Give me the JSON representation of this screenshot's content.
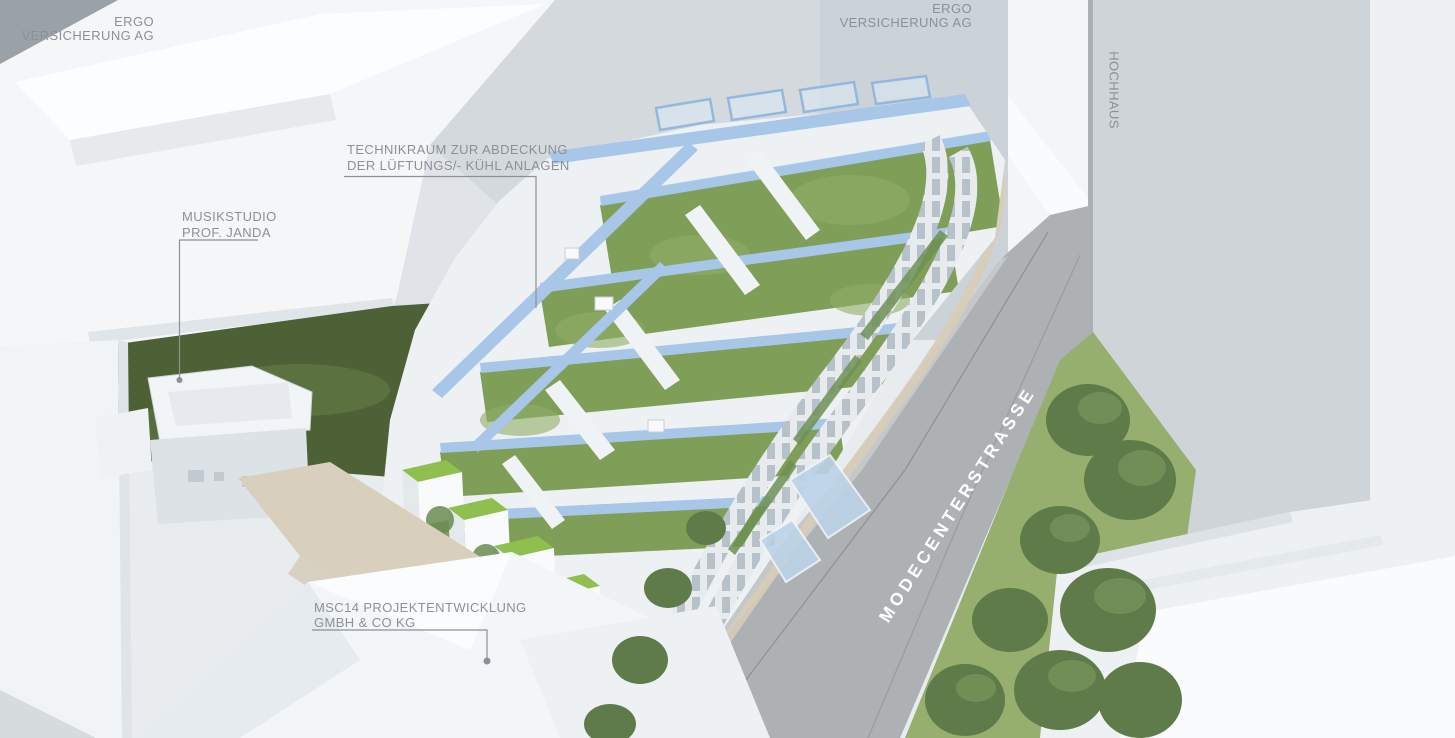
{
  "annotations": {
    "ergo_left": {
      "line1": "ERGO",
      "line2": "VERSICHERUNG AG"
    },
    "ergo_top": {
      "line1": "ERGO",
      "line2": "VERSICHERUNG AG"
    },
    "hochhaus": {
      "label": "HOCHHAUS"
    },
    "technikraum": {
      "line1": "TECHNIKRAUM ZUR ABDECKUNG",
      "line2": "DER LÜFTUNGS/- KÜHL ANLAGEN"
    },
    "musikstudio": {
      "line1": "MUSIKSTUDIO",
      "line2": "PROF. JANDA"
    },
    "msc14": {
      "line1": "MSC14 PROJEKTENTWICKLUNG",
      "line2": "GMBH & CO KG"
    },
    "street": {
      "label": "MODECENTERSTRASSE"
    }
  },
  "colors": {
    "label_text": "#8b9197",
    "street_text": "#ffffff",
    "lawn": "#4e6035",
    "roof_green": "#7f9e58",
    "bright_roof": "#8fbf4e",
    "solar_blue": "#a8c6e8",
    "street_gray": "#aeb1b3",
    "grass_strip": "#96ae6e",
    "tree_green": "#5e7b49",
    "hochhaus_face": "#cfd4d9"
  }
}
